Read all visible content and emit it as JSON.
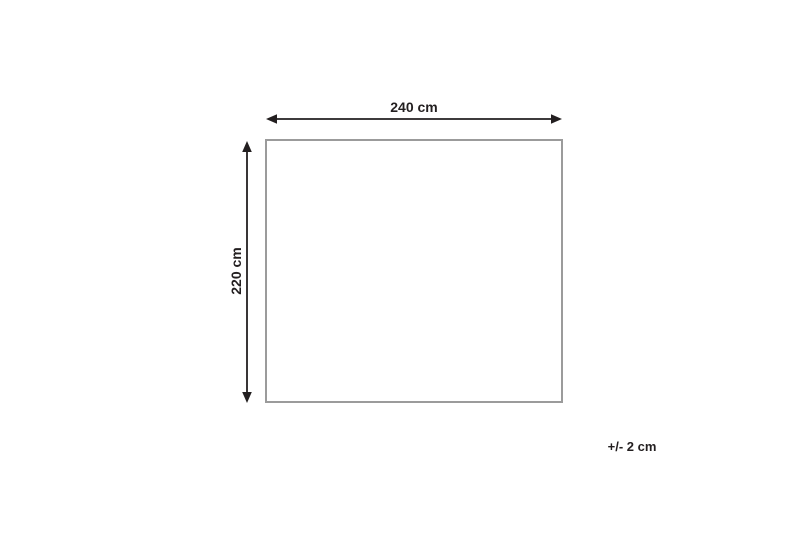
{
  "diagram": {
    "width_label": "240 cm",
    "height_label": "220 cm",
    "tolerance_label": "+/- 2 cm",
    "colors": {
      "ink": "#231f20",
      "outline": "#9b9b9b",
      "background": "#ffffff"
    }
  }
}
